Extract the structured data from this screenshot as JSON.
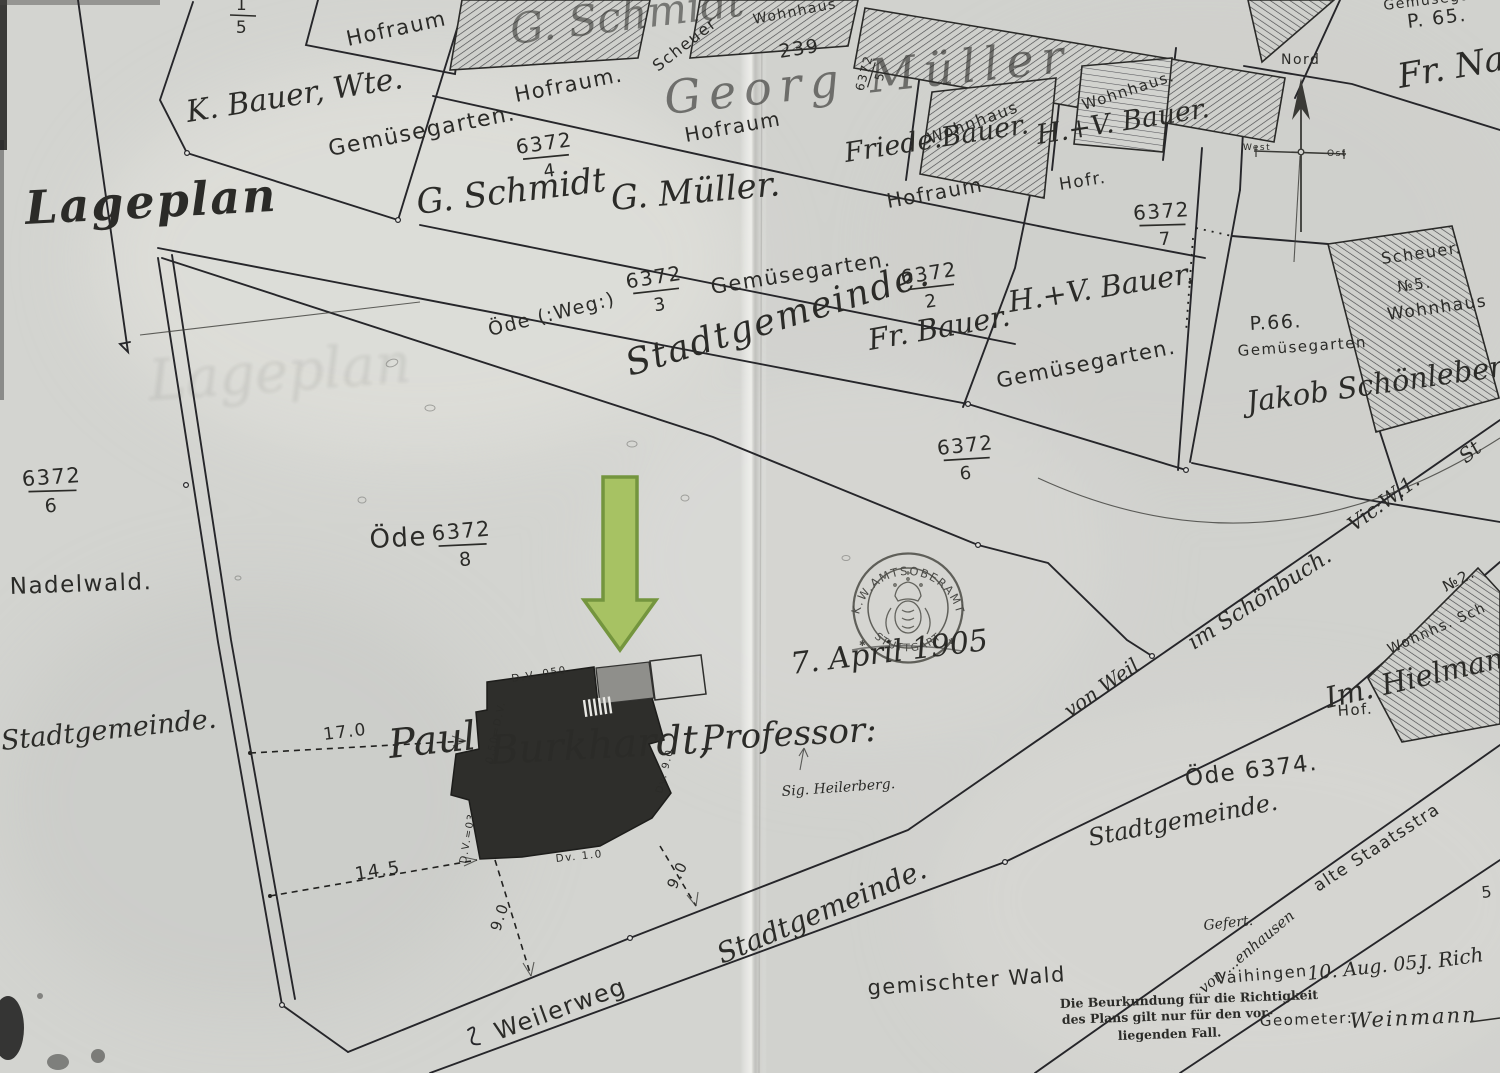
{
  "title": "Lageplan",
  "ghost_title": "Lageplan",
  "colors": {
    "arrow_fill": "#a7c263",
    "arrow_stroke": "#74953e",
    "ink": "#2b2b28",
    "paper": "#d3d4d0"
  },
  "compass": {
    "north": "Nord",
    "west": "West",
    "east": "Ost"
  },
  "stamp": {
    "arc_top": "K.W.AMTSOBERAMT",
    "arc_bottom": "STUTTGART",
    "date": "7. April 1905",
    "star": "✱"
  },
  "owners": {
    "k_bauer": "K. Bauer, Wte.",
    "g_schmidt": "G. Schmidt",
    "g_mueller": "G. Müller.",
    "g_schmidt_ghost": "G. Schmidt",
    "georg_mueller_ghost": "Georg Müller",
    "friede_bauer": "Friede.Bauer.",
    "hv_bauer_a": "H.+V. Bauer.",
    "fr_bauer": "Fr. Bauer.",
    "hv_bauer_b": "H.+V. Bauer.",
    "jakob_schoenleber": "Jakob Schönleber.",
    "fr_nag": "Fr. Nag",
    "im_hielman": "Im. Hielman",
    "paul": "Paul",
    "burkhardt": "Burkhardt,",
    "professor": "Professor:"
  },
  "landuse": {
    "hofraum_a": "Hofraum",
    "hofraum_b": "Hofraum.",
    "hofraum_c": "Hofraum",
    "hofraum_d": "Hofraum",
    "hofr": "Hofr.",
    "hof_right": "Hof.",
    "gemuese_a": "Gemüsegarten.",
    "gemuese_b": "Gemüsegarten.",
    "gemuese_c": "Gemüsegarten.",
    "gemuese_d": "Gemüsegarten",
    "gemuese_top": "Gemüsegart",
    "oede_weg": "Öde (:Weg:)",
    "oede": "Öde",
    "oede_6374": "Öde 6374.",
    "nadelwald": "Nadelwald.",
    "gemischter_wald": "gemischter Wald",
    "scheuer_ghost": "Scheuer",
    "wohnhaus_ghost": "Wohnhaus",
    "wohnhaus_a": "Wohnhaus",
    "wohnhaus_b": "Wohnhaus.",
    "scheuer_n5": "Scheuer.",
    "n5": "№5.",
    "wohnhaus_n5": "Wohnhaus",
    "no2": "№2.",
    "wohnhs_sch": "Wohnhs. Sch",
    "p65": "P. 65.",
    "p66": "P.66.",
    "n239": "239",
    "five": "5"
  },
  "streets": {
    "stadt_road": "Stadtgemeinde.",
    "stadt_left": "Stadtgemeinde.",
    "stadt_bottom": "Stadtgemeinde.",
    "stadt_right": "Stadtgemeinde.",
    "weilerweg": "Weilerweg",
    "von_weil": "von Weil",
    "im_schoenbuch": "im Schönbuch.",
    "vic_w1": "Vic:W:1.",
    "st": "St",
    "alte_staats": "alte Staatsstra"
  },
  "fractions": {
    "f15": {
      "num": "1",
      "den": "5"
    },
    "f4": {
      "num": "6372",
      "den": "4"
    },
    "f3": {
      "num": "6372",
      "den": "3"
    },
    "f2": {
      "num": "6372",
      "den": "2"
    },
    "f7": {
      "num": "6372",
      "den": "7"
    },
    "f6_road": {
      "num": "6372",
      "den": "6"
    },
    "f6_left": {
      "num": "6372",
      "den": "6"
    },
    "f8": {
      "num": "6372",
      "den": "8"
    },
    "f5": {
      "num": "6372",
      "den": "5"
    }
  },
  "measurements": {
    "m17": "17.0",
    "m145": "14.5",
    "m90a": "9.0",
    "m90b": "9.0",
    "dv050": "D.V. 050",
    "dv_half": "0.50=D.V.",
    "dv03": "D.V.=03",
    "dv10": "Dv. 1.0",
    "dv90": "Dv. 9.0"
  },
  "notes": {
    "sig": "Sig. Heilerberg.",
    "beurk1": "Die Beurkundung für die Richtigkeit",
    "beurk2": "des Plans gilt nur für den vor-",
    "beurk3": "liegenden Fall.",
    "gefert": "Gefert.",
    "von_hausen": "von ...enhausen",
    "vaihingen": "Vaihingen",
    "date2": "10. Aug. 05.",
    "rich": "J. Rich",
    "geometer": "Geometer:",
    "signature": "Weinmann"
  }
}
